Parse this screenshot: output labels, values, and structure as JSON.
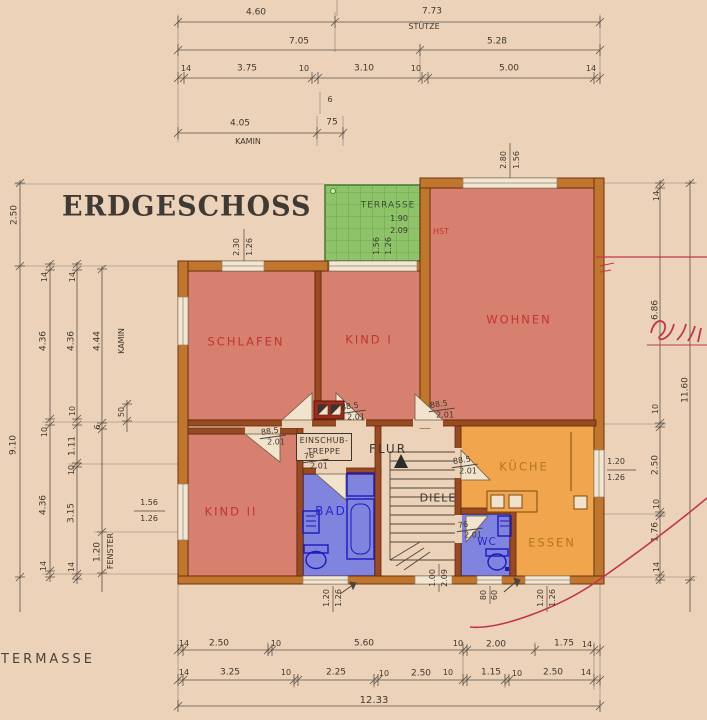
{
  "title": "ERDGESCHOSS",
  "footer_label": "TERMASSE",
  "plan": {
    "einschub_line1": "EINSCHUB-",
    "einschub_line2": "TREPPE"
  },
  "colors": {
    "paper": "#ecd2b8",
    "wall_exterior": "#c0762c",
    "wall_interior": "#9a4a20",
    "room_red": "#d8806f",
    "room_blue": "#8084de",
    "room_orange": "#f1a64e",
    "terrace_green": "#8fc36a",
    "label_red": "#c13434",
    "label_blue": "#2828cc",
    "label_orange": "#b5761c",
    "pen_red": "#c23550",
    "line": "#4d453c"
  },
  "rooms": [
    {
      "id": "schlafen",
      "label": "SCHLAFEN",
      "x": 246,
      "y": 342,
      "c": "red",
      "s": 11.5,
      "ls": 2
    },
    {
      "id": "kind1",
      "label": "KIND I",
      "x": 369,
      "y": 340,
      "c": "red",
      "s": 11.5,
      "ls": 2
    },
    {
      "id": "wohnen",
      "label": "WOHNEN",
      "x": 519,
      "y": 320,
      "c": "red",
      "s": 11.5,
      "ls": 2
    },
    {
      "id": "kind2",
      "label": "KIND II",
      "x": 231,
      "y": 512,
      "c": "red",
      "s": 11.5,
      "ls": 2
    },
    {
      "id": "bad",
      "label": "BAD",
      "x": 331,
      "y": 511,
      "c": "blue",
      "s": 12,
      "ls": 2
    },
    {
      "id": "wc",
      "label": "WC",
      "x": 487,
      "y": 542,
      "c": "blue",
      "s": 10.5,
      "ls": 1
    },
    {
      "id": "kueche",
      "label": "KÜCHE",
      "x": 524,
      "y": 467,
      "c": "orange",
      "s": 11.5,
      "ls": 2
    },
    {
      "id": "essen",
      "label": "ESSEN",
      "x": 552,
      "y": 543,
      "c": "orange",
      "s": 11.5,
      "ls": 2
    },
    {
      "id": "flur",
      "label": "FLUR",
      "x": 388,
      "y": 449,
      "c": "gray",
      "s": 12,
      "ls": 2
    },
    {
      "id": "diele",
      "label": "DIELE",
      "x": 438,
      "y": 498,
      "c": "gray",
      "s": 11,
      "ls": 1
    },
    {
      "id": "terrasse",
      "label": "TERRASSE",
      "x": 388,
      "y": 206,
      "c": "green",
      "s": 9,
      "ls": 1
    }
  ],
  "labels": [
    {
      "t": "4.60",
      "x": 256,
      "y": 13
    },
    {
      "t": "7.73",
      "x": 432,
      "y": 12
    },
    {
      "t": "STÜTZE",
      "x": 424,
      "y": 27,
      "s": 8
    },
    {
      "t": "7.05",
      "x": 299,
      "y": 42
    },
    {
      "t": "5.28",
      "x": 497,
      "y": 42
    },
    {
      "t": "14",
      "x": 186,
      "y": 69,
      "s": 8
    },
    {
      "t": "3.75",
      "x": 247,
      "y": 69
    },
    {
      "t": "10",
      "x": 304,
      "y": 69,
      "s": 8
    },
    {
      "t": "3.10",
      "x": 364,
      "y": 69
    },
    {
      "t": "10",
      "x": 416,
      "y": 69,
      "s": 8
    },
    {
      "t": "5.00",
      "x": 509,
      "y": 69
    },
    {
      "t": "14",
      "x": 591,
      "y": 69,
      "s": 8
    },
    {
      "t": "6",
      "x": 330,
      "y": 100,
      "s": 8
    },
    {
      "t": "4.05",
      "x": 240,
      "y": 124
    },
    {
      "t": "75",
      "x": 332,
      "y": 123
    },
    {
      "t": "KAMIN",
      "x": 248,
      "y": 142,
      "s": 8
    },
    {
      "t": "2.50",
      "x": 15,
      "y": 215,
      "r": -90
    },
    {
      "t": "9.10",
      "x": 14,
      "y": 445,
      "r": -90
    },
    {
      "t": "14",
      "x": 45,
      "y": 277,
      "r": -90,
      "s": 8
    },
    {
      "t": "4.36",
      "x": 44,
      "y": 341,
      "r": -90
    },
    {
      "t": "10",
      "x": 45,
      "y": 432,
      "r": -90,
      "s": 8
    },
    {
      "t": "4.36",
      "x": 44,
      "y": 505,
      "r": -90
    },
    {
      "t": "14",
      "x": 44,
      "y": 566,
      "r": -90,
      "s": 8
    },
    {
      "t": "14",
      "x": 73,
      "y": 277,
      "r": -90,
      "s": 8
    },
    {
      "t": "4.36",
      "x": 72,
      "y": 341,
      "r": -90
    },
    {
      "t": "10",
      "x": 73,
      "y": 411,
      "r": -90,
      "s": 8
    },
    {
      "t": "1.11",
      "x": 73,
      "y": 446,
      "r": -90
    },
    {
      "t": "10",
      "x": 72,
      "y": 470,
      "r": -90,
      "s": 8
    },
    {
      "t": "3.15",
      "x": 72,
      "y": 513,
      "r": -90
    },
    {
      "t": "14",
      "x": 72,
      "y": 567,
      "r": -90,
      "s": 8
    },
    {
      "t": "4.44",
      "x": 98,
      "y": 341,
      "r": -90
    },
    {
      "t": "KAMIN",
      "x": 122,
      "y": 341,
      "r": -90,
      "s": 8
    },
    {
      "t": "6",
      "x": 98,
      "y": 427,
      "r": -90,
      "s": 8
    },
    {
      "t": "50",
      "x": 122,
      "y": 412,
      "r": -90,
      "s": 8
    },
    {
      "t": "1.20",
      "x": 98,
      "y": 552,
      "r": -90
    },
    {
      "t": "FENSTER",
      "x": 111,
      "y": 551,
      "r": -90,
      "s": 8
    },
    {
      "t": "14",
      "x": 657,
      "y": 196,
      "r": -90,
      "s": 8
    },
    {
      "t": "6.86",
      "x": 656,
      "y": 310,
      "r": -90
    },
    {
      "t": "10",
      "x": 656,
      "y": 409,
      "r": -90,
      "s": 8
    },
    {
      "t": "2.50",
      "x": 656,
      "y": 465,
      "r": -90
    },
    {
      "t": "10",
      "x": 657,
      "y": 504,
      "r": -90,
      "s": 8
    },
    {
      "t": "1.76",
      "x": 656,
      "y": 532,
      "r": -90
    },
    {
      "t": "14",
      "x": 657,
      "y": 567,
      "r": -90,
      "s": 8
    },
    {
      "t": "11.60",
      "x": 686,
      "y": 390,
      "r": -90
    },
    {
      "t": "1.20",
      "x": 616,
      "y": 462,
      "s": 8
    },
    {
      "t": "1.26",
      "x": 616,
      "y": 478,
      "s": 8
    },
    {
      "t": "14",
      "x": 184,
      "y": 644,
      "s": 8
    },
    {
      "t": "2.50",
      "x": 219,
      "y": 644
    },
    {
      "t": "10",
      "x": 276,
      "y": 644,
      "s": 8
    },
    {
      "t": "5.60",
      "x": 364,
      "y": 644
    },
    {
      "t": "10",
      "x": 458,
      "y": 644,
      "s": 8
    },
    {
      "t": "2.00",
      "x": 496,
      "y": 645
    },
    {
      "t": "1.75",
      "x": 564,
      "y": 644
    },
    {
      "t": "14",
      "x": 587,
      "y": 645,
      "s": 8
    },
    {
      "t": "14",
      "x": 184,
      "y": 673,
      "s": 8
    },
    {
      "t": "3.25",
      "x": 230,
      "y": 673
    },
    {
      "t": "10",
      "x": 286,
      "y": 673,
      "s": 8
    },
    {
      "t": "2.25",
      "x": 336,
      "y": 673
    },
    {
      "t": "10",
      "x": 384,
      "y": 674,
      "s": 8
    },
    {
      "t": "2.50",
      "x": 421,
      "y": 674
    },
    {
      "t": "10",
      "x": 448,
      "y": 673,
      "s": 8
    },
    {
      "t": "1.15",
      "x": 491,
      "y": 673
    },
    {
      "t": "10",
      "x": 517,
      "y": 674,
      "s": 8
    },
    {
      "t": "2.50",
      "x": 553,
      "y": 673
    },
    {
      "t": "14",
      "x": 586,
      "y": 673,
      "s": 8
    },
    {
      "t": "12.33",
      "x": 374,
      "y": 701,
      "s": 10
    },
    {
      "t": "2.30",
      "x": 237,
      "y": 247,
      "r": -90,
      "s": 8
    },
    {
      "t": "1.26",
      "x": 250,
      "y": 247,
      "r": -90,
      "s": 8
    },
    {
      "t": "2.80",
      "x": 504,
      "y": 160,
      "r": -90,
      "s": 8
    },
    {
      "t": "1.56",
      "x": 517,
      "y": 160,
      "r": -90,
      "s": 8
    },
    {
      "t": "1.90",
      "x": 399,
      "y": 219,
      "s": 8
    },
    {
      "t": "2.09",
      "x": 399,
      "y": 231,
      "s": 8
    },
    {
      "t": "1.56",
      "x": 377,
      "y": 246,
      "r": -90,
      "s": 8
    },
    {
      "t": "1.26",
      "x": 389,
      "y": 246,
      "r": -90,
      "s": 8
    },
    {
      "t": "HST",
      "x": 441,
      "y": 232,
      "s": 8,
      "c": "red"
    },
    {
      "t": "1.56",
      "x": 149,
      "y": 503,
      "s": 8
    },
    {
      "t": "1.26",
      "x": 149,
      "y": 519,
      "s": 8
    },
    {
      "t": "1.00",
      "x": 433,
      "y": 578,
      "r": -90,
      "s": 8
    },
    {
      "t": "2.09",
      "x": 445,
      "y": 578,
      "r": -90,
      "s": 8
    },
    {
      "t": "80",
      "x": 484,
      "y": 595,
      "r": -90,
      "s": 8
    },
    {
      "t": "60",
      "x": 495,
      "y": 595,
      "r": -90,
      "s": 8
    },
    {
      "t": "1.20",
      "x": 327,
      "y": 598,
      "r": -90,
      "s": 8
    },
    {
      "t": "1.26",
      "x": 339,
      "y": 598,
      "r": -90,
      "s": 8
    },
    {
      "t": "1.20",
      "x": 541,
      "y": 598,
      "r": -90,
      "s": 8
    },
    {
      "t": "1.26",
      "x": 553,
      "y": 598,
      "r": -90,
      "s": 8
    }
  ],
  "fractions": [
    {
      "t": "88.5",
      "b": "2.01",
      "x": 272,
      "y": 437
    },
    {
      "t": "88.5",
      "b": "2.01",
      "x": 352,
      "y": 412
    },
    {
      "t": "88.5",
      "b": "2.01",
      "x": 441,
      "y": 410
    },
    {
      "t": "88.5",
      "b": "2.01",
      "x": 464,
      "y": 466
    },
    {
      "t": "76",
      "b": "2.01",
      "x": 315,
      "y": 461
    },
    {
      "t": "76",
      "b": "2.01",
      "x": 469,
      "y": 530
    }
  ]
}
